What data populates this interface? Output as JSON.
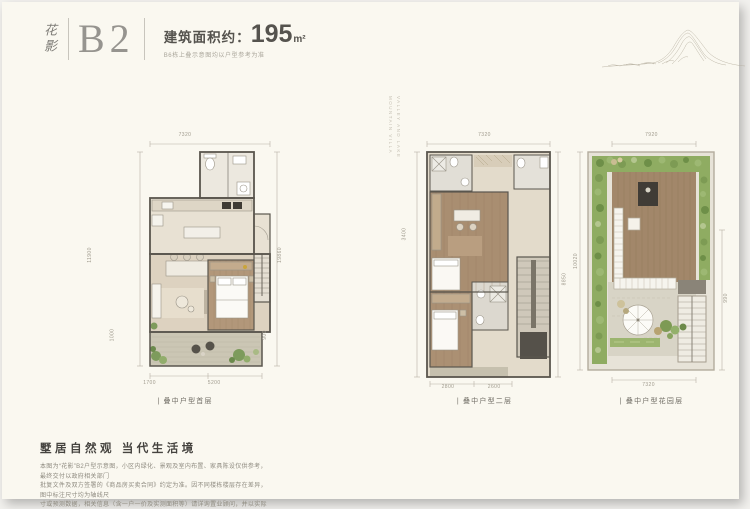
{
  "header": {
    "brand": "花影",
    "unit": "B2",
    "area_label": "建筑面积约：",
    "area_value": "195",
    "area_unit": "m²",
    "subtitle": "B6栋上叠示意图均以户型参考为准"
  },
  "watermark": {
    "line1": "VALLEY AND LAKE",
    "line2": "MOUNTAIN VILLA"
  },
  "plans": [
    {
      "caption": "| 叠中户型首层",
      "dims": {
        "top": "7320",
        "left": "11900",
        "right": "19860",
        "side_left": "1000",
        "side_right": "900",
        "bottom_left": "1700",
        "bottom_right": "5200"
      }
    },
    {
      "caption": "| 叠中户型二层",
      "dims": {
        "top": "7320",
        "left": "3400",
        "right": "8850",
        "bottom_left": "2800",
        "bottom_right": "2600"
      }
    },
    {
      "caption": "| 叠中户型花园层",
      "dims": {
        "top": "7920",
        "left": "10020",
        "right": "990",
        "bottom": "7320"
      }
    }
  ],
  "footer": {
    "heading": "墅居自然观 当代生活境",
    "lines": [
      "本图为“花影”B2户型示意图，小区内绿化、景观及室内布置、家具陈设仅供参考，最终交付以政府相关部门",
      "批复文件及双方签署的《商品房买卖合同》约定为准。因不同楼栋楼层存在差异，图中标注尺寸均为轴线尺",
      "寸或预测数据，相关信息（含一户一价及实测面积等）请详询置业顾问，并以实际交付为准。",
      "部分图片为效果示意图，敬请知悉。"
    ]
  },
  "colors": {
    "page_bg": "#FAF8F0",
    "wall": "#5A564E",
    "wood_floor": "#B2977A",
    "terrace": "#CBC6B4",
    "garden_green": "#8FAC62"
  }
}
